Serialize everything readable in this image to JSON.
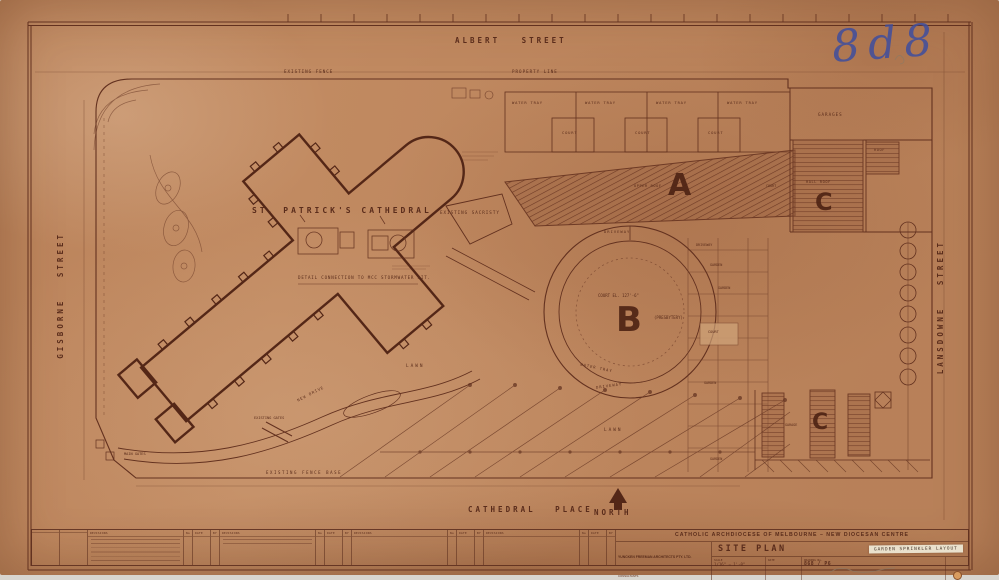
{
  "annotations": {
    "sheet_number_handwritten": "8d8"
  },
  "streets": {
    "top": "ALBERT STREET",
    "left": "GISBORNE STREET",
    "right": "LANSDOWNE STREET",
    "bottom": "CATHEDRAL PLACE",
    "north_label": "NORTH"
  },
  "plan": {
    "cathedral": "ST. PATRICK'S CATHEDRAL",
    "sacristy": "EXISTING SACRISTY",
    "detail_caption": "DETAIL CONNECTION TO MCC STORMWATER PIT.",
    "existing_fence": "EXISTING FENCE",
    "property_line": "PROPERTY LINE",
    "water_tray": "WATER TRAY",
    "court": "COURT",
    "building_a": "A",
    "building_b": "B",
    "building_c": "C",
    "upper_roof": "UPPER ROOF",
    "hall_roof": "HALL ROOF",
    "roof": "ROOF",
    "garages": "GARAGES",
    "garage": "GARAGE",
    "court_elevation": "COURT  EL. 127'-6\"",
    "presbytery": "(PRESBYTERY)",
    "driveway": "DRIVEWAY",
    "garden": "GARDEN",
    "lawn": "LAWN",
    "main_gates": "MAIN GATES",
    "existing_gates": "EXISTING GATES",
    "existing_fence_base": "EXISTING FENCE BASE",
    "new_drive": "NEW DRIVE"
  },
  "title_block": {
    "client": "CATHOLIC   ARCHDIOCESE   OF   MELBOURNE   –   NEW   DIOCESAN   CENTRE",
    "architects": "YUNCKEN FREEMAN ARCHITECTS PTY. LTD.",
    "consultants_label": "CONSULTANTS",
    "title": "SITE PLAN",
    "subtitle": "GARDEN  SPRINKLER  LAYOUT",
    "scale_label": "SCALE",
    "scale_value": "1/16\" = 1'-0\"",
    "date_label": "DATE",
    "drawing_no_label": "DRAWING No.",
    "drawing_number": "868 / P6",
    "revisions_header": "REVISIONS",
    "col_no": "No",
    "col_date": "DATE",
    "col_by": "BY"
  },
  "colors": {
    "paper": "#c18a61",
    "ink": "#5a2c1b",
    "blue_ink": "#3f4e9e",
    "tape": "#eae1cd"
  }
}
